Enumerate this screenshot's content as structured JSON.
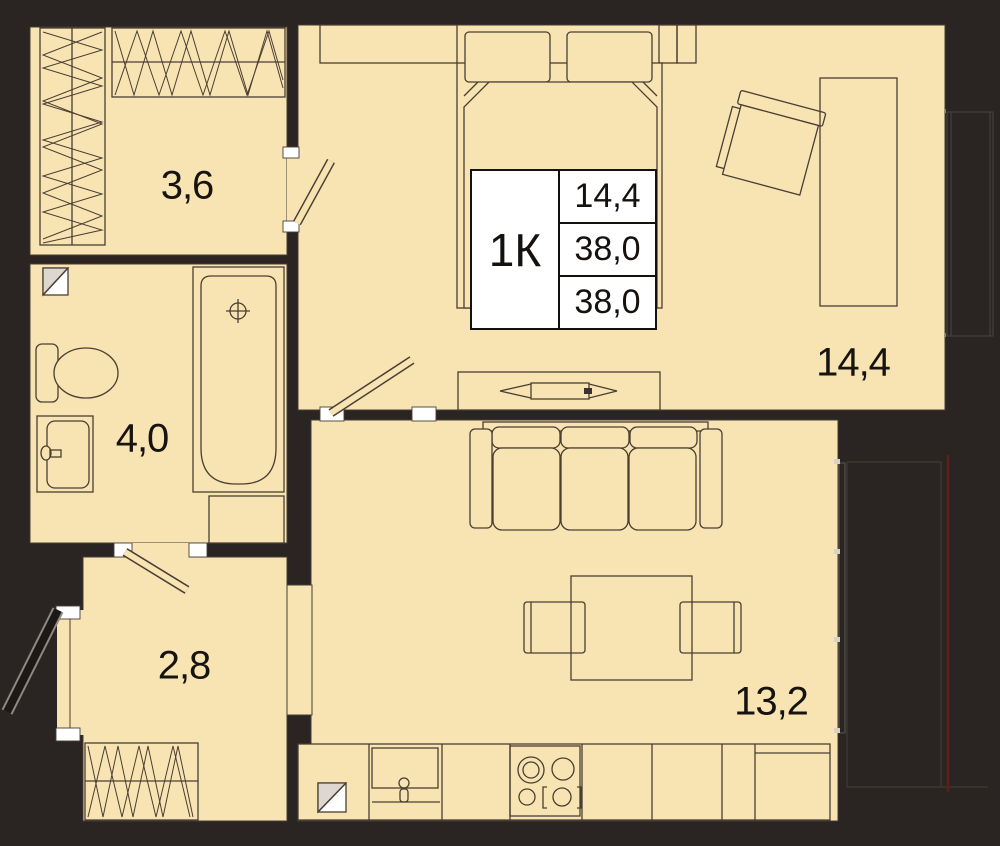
{
  "plan": {
    "title": "1K apartment floor plan",
    "info_box": {
      "type_label": "1К",
      "values": [
        "14,4",
        "38,0",
        "38,0"
      ]
    },
    "rooms": [
      {
        "name": "wardrobe",
        "area": "3,6"
      },
      {
        "name": "bathroom",
        "area": "4,0"
      },
      {
        "name": "hallway",
        "area": "2,8"
      },
      {
        "name": "bedroom",
        "area": "14,4"
      },
      {
        "name": "kitchen-living-room",
        "area": "13,2"
      }
    ],
    "colors": {
      "floor": "#f8e4b2",
      "wall": "#2a2423",
      "line": "#4a3e33",
      "balcony_line": "#5e1f18",
      "info_bg": "#ffffff",
      "text": "#161310"
    }
  }
}
